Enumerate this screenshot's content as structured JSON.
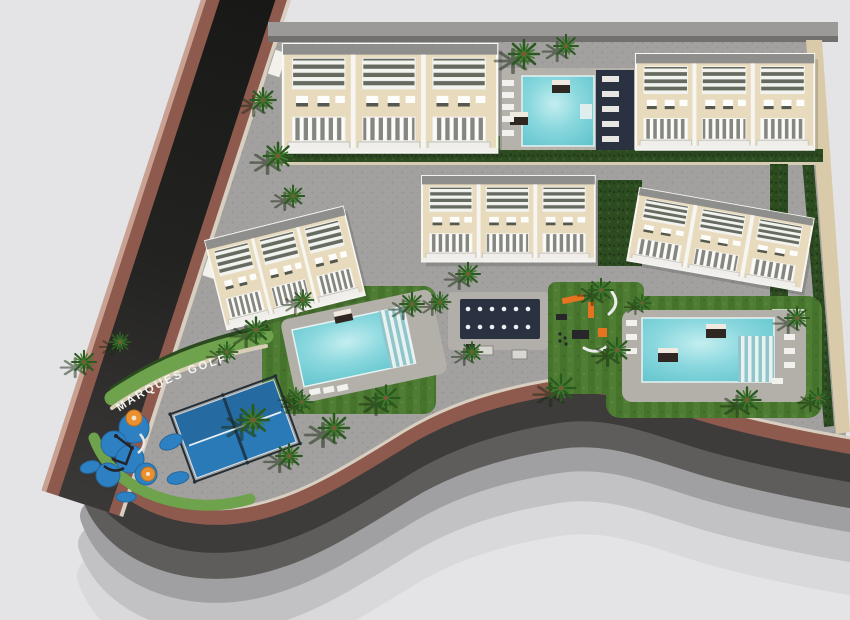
{
  "labels": {
    "street_sign": "MARQUES GOLF"
  },
  "colors": {
    "background": "#e4e4e6",
    "asphalt": "#2b2a28",
    "sidewalk_brick": "#8e5a4e",
    "paving": "#a2a19f",
    "grass": "#4e7d33",
    "hedge": "#2d4b21",
    "pool_water": "#7dd3da",
    "pool_deck": "#b3afa9",
    "building_terrace": "#e8dbbd",
    "building_trim": "#f6f5f1",
    "roof_gray": "#8e8e8c",
    "navy_deck": "#2a3140",
    "padel_blue": "#2b7ab8",
    "playground_blue": "#2d80c1",
    "accent_orange": "#e9902f",
    "path_beige": "#d9cfb6",
    "boundary_beige": "#d9cba9",
    "text_white": "#f4f4f2"
  },
  "site": {
    "development_label": "MARQUES GOLF",
    "buildings": [
      {
        "name": "residential-block-north-west",
        "units_visible": 3
      },
      {
        "name": "residential-block-north-east",
        "units_visible": 3
      },
      {
        "name": "residential-block-center",
        "units_visible": 3
      },
      {
        "name": "residential-block-west",
        "units_visible": 3
      },
      {
        "name": "residential-block-east",
        "units_visible": 3
      }
    ],
    "amenities": [
      "swimming-pool-north",
      "swimming-pool-west",
      "swimming-pool-east",
      "padel-court",
      "children-playground",
      "outdoor-gym",
      "chill-out-deck",
      "picnic-tables",
      "palm-garden"
    ]
  }
}
